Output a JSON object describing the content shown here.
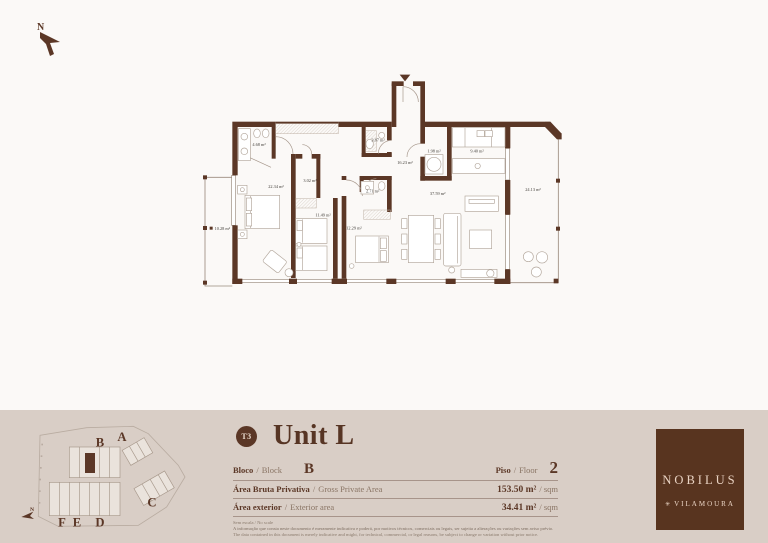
{
  "compass": {
    "north": "N"
  },
  "floor_plan": {
    "rooms": [
      {
        "name": "bathroom-1",
        "area": "4.68 m²"
      },
      {
        "name": "wc",
        "area": "3.87 m²"
      },
      {
        "name": "laundry",
        "area": "1.98 m²"
      },
      {
        "name": "kitchen",
        "area": "9.40 m²"
      },
      {
        "name": "hall",
        "area": "16.23 m²"
      },
      {
        "name": "closet",
        "area": "3.02 m²"
      },
      {
        "name": "bedroom-1",
        "area": "22.34 m²"
      },
      {
        "name": "terrace-right",
        "area": "24.13 m²"
      },
      {
        "name": "bathroom-2",
        "area": "2.71 m²"
      },
      {
        "name": "living-dining",
        "area": "37.59 m²"
      },
      {
        "name": "bedroom-2",
        "area": "11.49 m²"
      },
      {
        "name": "bedroom-3",
        "area": "12.29 m²"
      },
      {
        "name": "terrace-left",
        "area": "10.28 m²"
      }
    ]
  },
  "site_plan": {
    "blocks": [
      "A",
      "B",
      "C",
      "D",
      "E",
      "F"
    ],
    "north": "N"
  },
  "unit": {
    "type_badge": "T3",
    "title": "Unit L",
    "sep": "/",
    "block_label_pt": "Bloco",
    "block_label_en": "Block",
    "block_value": "B",
    "floor_label_pt": "Piso",
    "floor_label_en": "Floor",
    "floor_value": "2",
    "gross_area_label_pt": "Área Bruta Privativa",
    "gross_area_label_en": "Gross Private Area",
    "gross_area_value": "153.50 m²",
    "gross_area_unit": "/ sqm",
    "exterior_area_label_pt": "Área exterior",
    "exterior_area_label_en": "Exterior area",
    "exterior_area_value": "34.41 m²",
    "exterior_area_unit": "/ sqm"
  },
  "disclaimer": {
    "scale_note": "Sem escala / No scale",
    "line_pt": "A informação que consta neste documento é meramente indicativa e poderá, por motivos técnicos, comerciais ou legais, ser sujeita a alterações ou variações sem aviso prévio.",
    "line_en": "The data contained in this document is merely indicative and might, for technical, commercial, or legal reasons, be subject to change or variation without prior notice."
  },
  "brand": {
    "name": "NOBILUS",
    "location": "VILAMOURA",
    "flower_icon": "✳"
  },
  "colors": {
    "brown": "#5b3726",
    "band": "#d9cec6",
    "page": "#fbf9f7",
    "logo_bg": "#58341f"
  }
}
